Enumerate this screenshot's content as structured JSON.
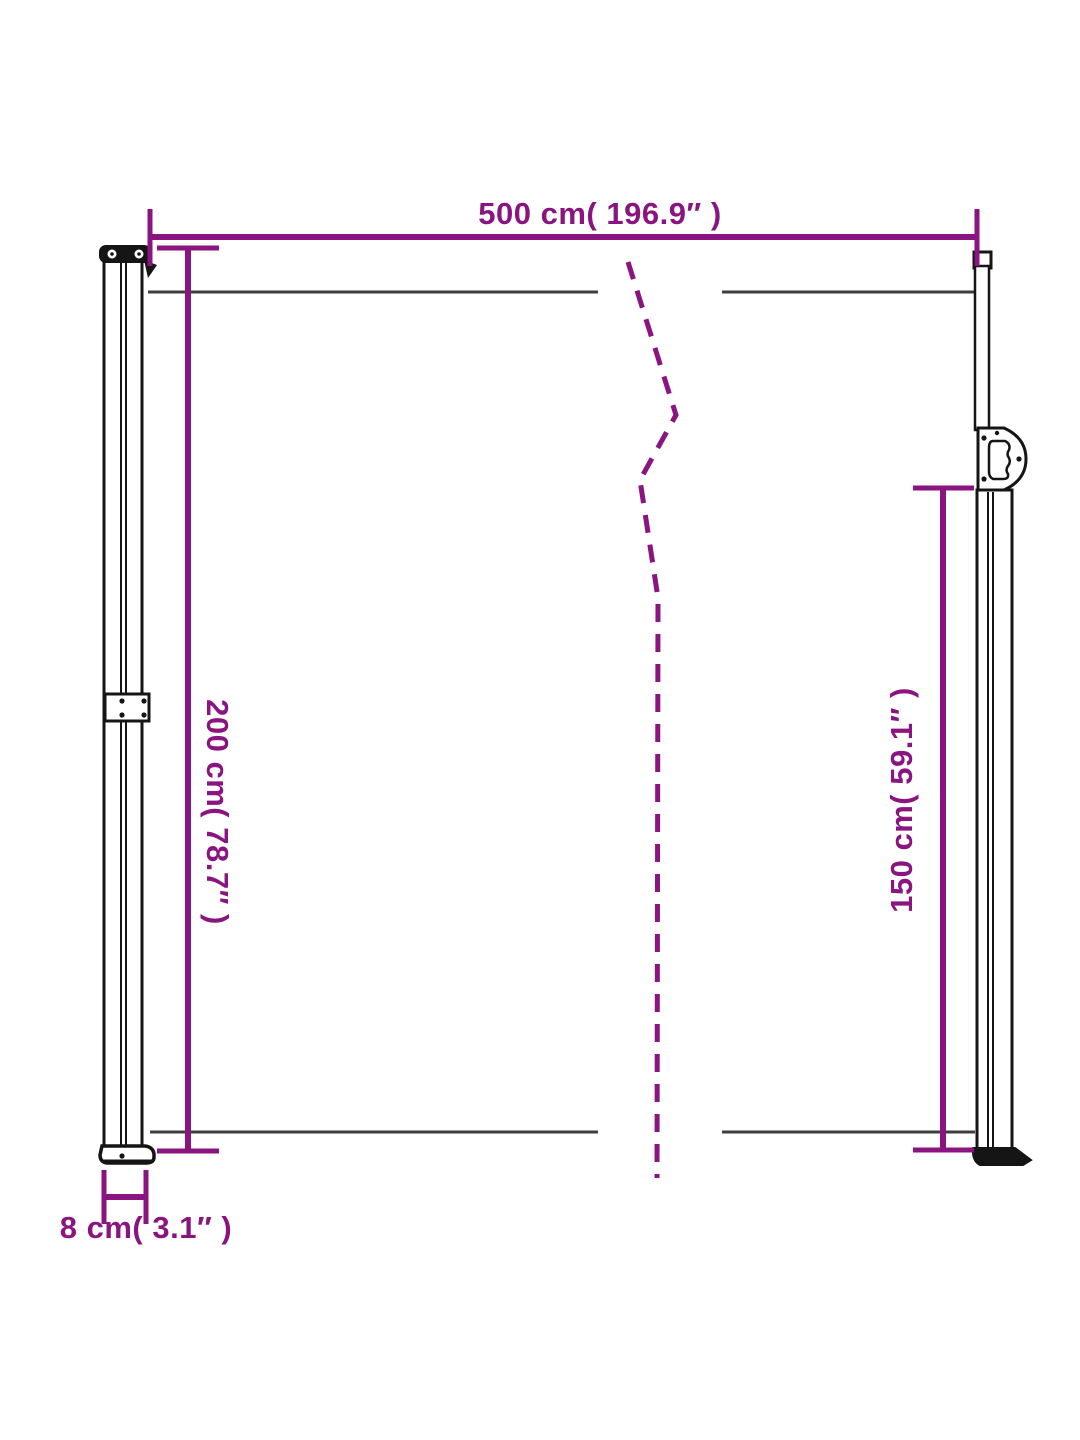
{
  "diagram": {
    "kind": "product-dimension-diagram",
    "colors": {
      "dimension_accent": "#8A1480",
      "panel_edge_gray": "#3E3E3E",
      "frame_black": "#151515",
      "background": "#FFFFFF"
    },
    "dimensions": {
      "width": {
        "label": "500 cm( 196.9″ )",
        "cm": "500",
        "inches": "196.9"
      },
      "height_left": {
        "label": "200 cm( 78.7″ )",
        "cm": "200",
        "inches": "78.7"
      },
      "height_right": {
        "label": "150 cm( 59.1″ )",
        "cm": "150",
        "inches": "59.1"
      },
      "depth": {
        "label": "8 cm( 3.1″ )",
        "cm": "8",
        "inches": "3.1"
      }
    }
  }
}
